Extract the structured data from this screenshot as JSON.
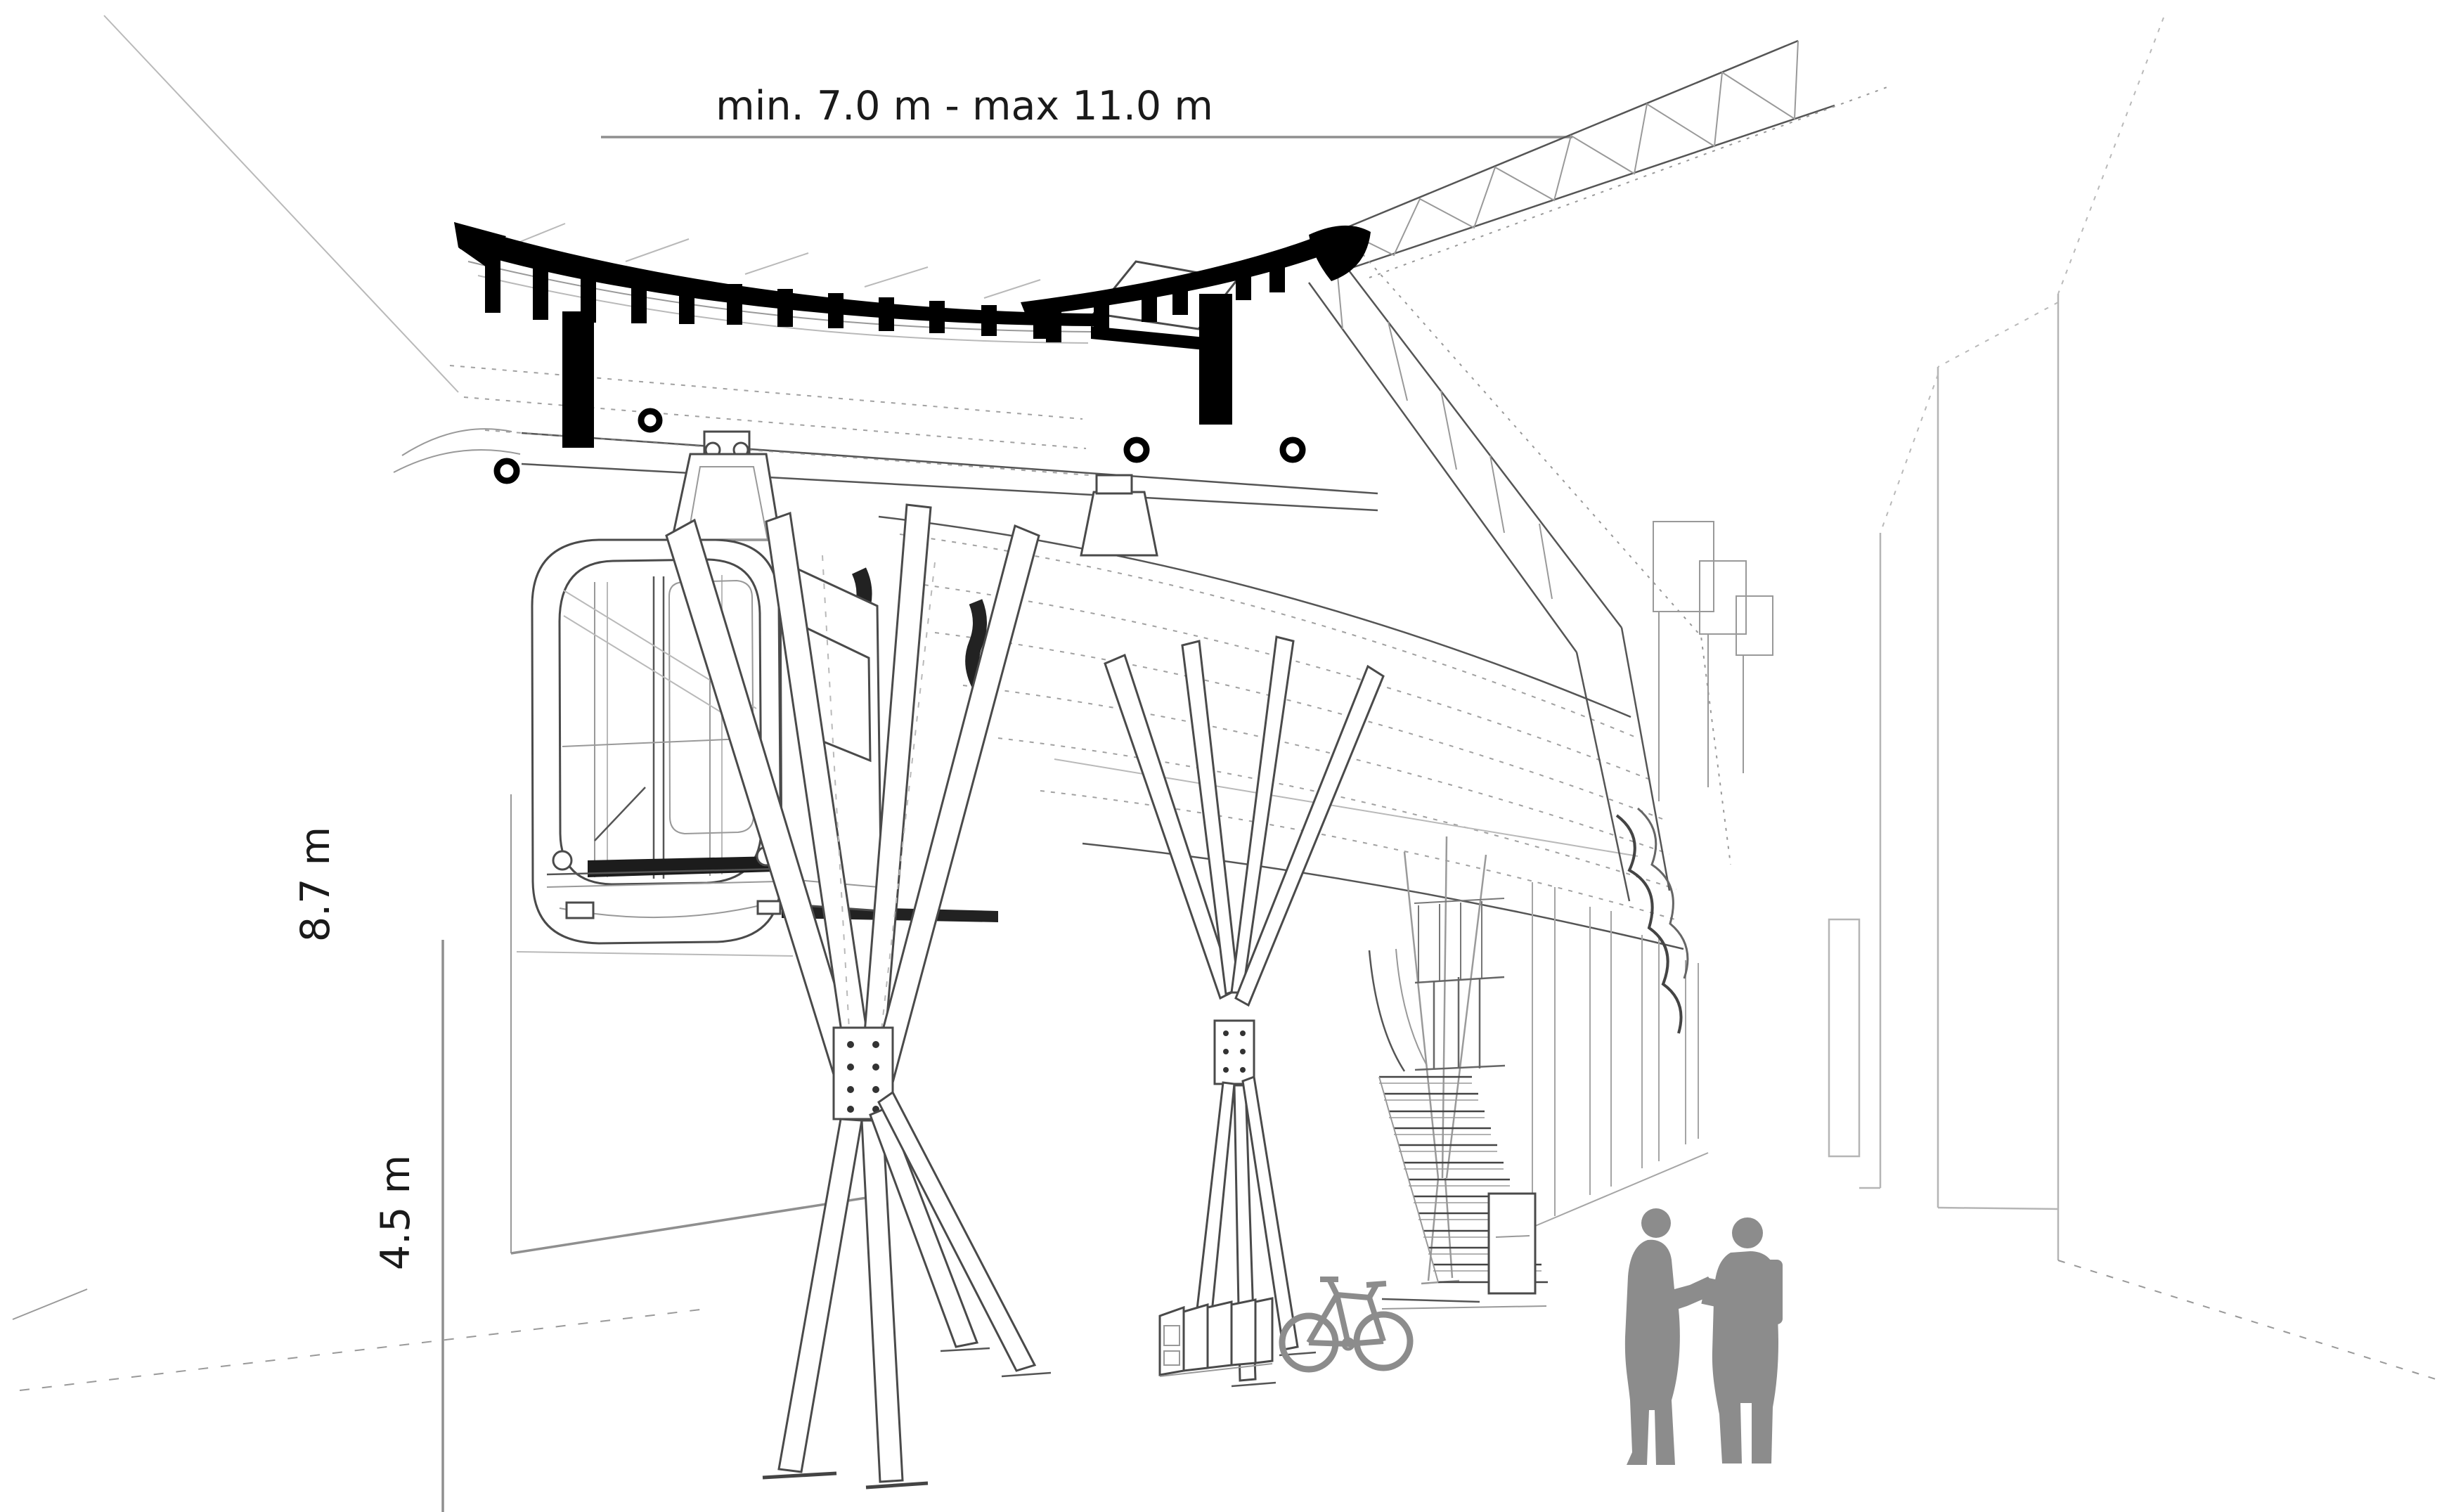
{
  "annotations": {
    "width_range": "min. 7.0 m - max 11.0 m",
    "height_total": "8.7 m",
    "height_clearance": "4.5 m"
  },
  "drawing": {
    "type": "architectural-section-perspective",
    "subject": "suspended-monorail-station-canopy-with-tree-columns",
    "elements": [
      "curved canopy roof with black louvre fins",
      "lattice truss sweeping to upper right",
      "suspended train cabin front",
      "branching tree columns",
      "staircase",
      "bike rack with bicycle",
      "two people talking",
      "dimension lines"
    ]
  },
  "colors": {
    "background": "#ffffff",
    "ink": "#1a1a1a",
    "drawing_line": "#555555",
    "faint_line": "#b5b5b5",
    "dimension_line": "#8f8f8f",
    "silhouette_gray": "#8c8c8c",
    "solid_black": "#000000"
  }
}
